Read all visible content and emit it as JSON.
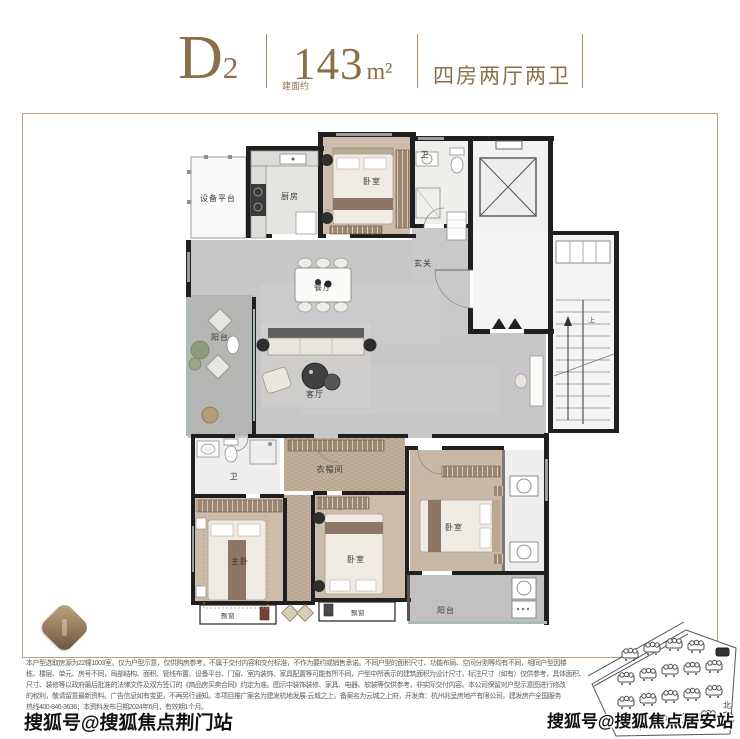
{
  "header": {
    "unit_code": "D",
    "unit_code_sub": "2",
    "area_label_vertical": "建面约",
    "area_value": "143",
    "area_unit": "m²",
    "room_config": "四房两厅两卫",
    "accent_color": "#8c6f49"
  },
  "floorplan": {
    "frame_border_color": "#b89f83",
    "labels": {
      "equipment_platform": "设备平台",
      "kitchen": "厨房",
      "bedroom": "卧室",
      "bathroom": "卫",
      "foyer": "玄关",
      "dining_room": "餐厅",
      "living_room": "客厅",
      "balcony": "阳台",
      "cloakroom": "衣帽间",
      "master_bedroom": "主卧",
      "bay_window": "飘窗",
      "stairs_up": "上"
    }
  },
  "disclaimer": {
    "lines": [
      "本户型选取房源为22幢1003室，仅为户型示意，仅供购房参考，不属于交付内容和交付标准，不作为要约或销售承诺。不同户型的面积尺寸、功能布局、空间分割等均有不同，相同户型因楼",
      "栋、楼层、单元、房号不同，局部结构、面积、管线布置、设备平台、门窗、室内装饰、家具配置等可能有所不同，户型中所表示的建筑面积为设计尺寸，标注尺寸（如有）仅供参考，具体面积、",
      "尺寸、装修等以政府最后批准的法律文件及双方签订的《商品房买卖合同》约定为准。图示中装饰装修、家具、电器、软装等仅供参考，非实际交付内容。本公司保留对户型示意图进行修改",
      "的权利，敬请留意最新资料。广告信息如有变更，不再另行通知。本项目推广案名为建发杭地发展·云城之上，备案名为云城之上府，开发商：杭州兆呈房地产有限公司。建发房产全国服务",
      "热线400-846-3636；本资料发布日期2024年6月，有效期1个月。"
    ]
  },
  "watermarks": {
    "bottom_left": "搜狐号@搜狐焦点荆门站",
    "bottom_right": "搜狐号@搜狐焦点居安站"
  },
  "site_plan": {
    "north_label": "北"
  }
}
